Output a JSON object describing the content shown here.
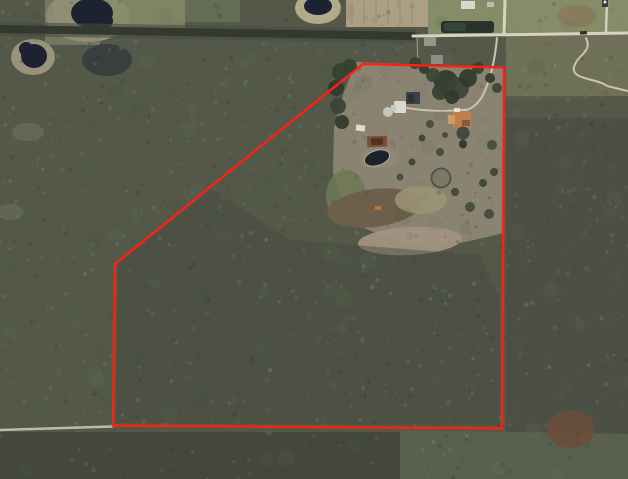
{
  "meta": {
    "description": "Aerial satellite view of a rural wooded parcel with a red property-boundary outline, a homestead clearing with buildings in the upper middle, ponds at top left, and dirt roads",
    "canvas": {
      "width": 628,
      "height": 479
    }
  },
  "palette": {
    "forest_base": "#535848",
    "forest_dark": "#33382e",
    "forest_light": "#7e8573",
    "clearing": "#8b8372",
    "water": "#1d2233",
    "road_light": "#d8d3c1",
    "boundary_red": "#ff2014"
  },
  "boundary": {
    "name": "property-boundary",
    "color": "#ff2014",
    "stroke_width": 2.4,
    "points": "363,64 504,67.5 502,428.5 113,425.5 115,264 210,187"
  },
  "terrain_regions": [
    {
      "name": "forest-base",
      "shape": "rect",
      "x": 0,
      "y": 0,
      "w": 628,
      "h": 479,
      "fill": "#535848"
    },
    {
      "name": "shore-northwest-pond",
      "shape": "ellipse",
      "cx": 88,
      "cy": 16,
      "rx": 42,
      "ry": 26,
      "fill": "#98937a"
    },
    {
      "name": "shore-west-pond",
      "shape": "ellipse",
      "cx": 33,
      "cy": 57,
      "rx": 22,
      "ry": 18,
      "fill": "#98937a"
    },
    {
      "name": "shore-connector",
      "shape": "rect",
      "x": 45,
      "y": 0,
      "w": 55,
      "h": 45,
      "fill": "#8d8871",
      "opacity": 0.6
    },
    {
      "name": "field-northwest",
      "shape": "rect",
      "x": 95,
      "y": 0,
      "w": 90,
      "h": 30,
      "fill": "#868c6a",
      "opacity": 0.85
    },
    {
      "name": "field-north",
      "shape": "rect",
      "x": 185,
      "y": 0,
      "w": 55,
      "h": 22,
      "fill": "#6f765c",
      "opacity": 0.7
    },
    {
      "name": "shore-north-center-pond",
      "shape": "ellipse",
      "cx": 318,
      "cy": 8,
      "rx": 23,
      "ry": 16,
      "fill": "#b3aa8c"
    },
    {
      "name": "plowed-field-north",
      "shape": "rect",
      "x": 346,
      "y": 0,
      "w": 82,
      "h": 27,
      "fill": "#ac9f83"
    },
    {
      "name": "lawn-northeast",
      "shape": "polygon",
      "points": "428,0 628,0 628,32 428,34",
      "fill": "#858d68"
    },
    {
      "name": "bare-patch-northeast",
      "shape": "ellipse",
      "cx": 577,
      "cy": 16,
      "rx": 20,
      "ry": 11,
      "fill": "#8a795c",
      "opacity": 0.85
    },
    {
      "name": "scrub-field-east",
      "shape": "polygon",
      "points": "506,36 628,34 628,96 506,101",
      "fill": "#6e7157"
    },
    {
      "name": "scrub-fade-east",
      "shape": "rect",
      "x": 506,
      "y": 96,
      "w": 122,
      "h": 26,
      "fill": "#565749",
      "opacity": 0.85
    },
    {
      "name": "forest-east",
      "shape": "rect",
      "x": 506,
      "y": 118,
      "w": 122,
      "h": 361,
      "fill": "#4b5044",
      "opacity": 0.9
    },
    {
      "name": "homestead-clearing",
      "shape": "polygon",
      "points": "356,62 504,68 504,233 470,241 432,248 396,241 364,228 342,206 333,172 334,128 344,92",
      "fill": "#8b8372"
    },
    {
      "name": "meadow-west-of-clearing",
      "shape": "ellipse",
      "cx": 346,
      "cy": 196,
      "rx": 20,
      "ry": 26,
      "fill": "#6e7854",
      "opacity": 0.9
    },
    {
      "name": "dirt-swath",
      "shape": "ellipse",
      "cx": 374,
      "cy": 208,
      "rx": 47,
      "ry": 19,
      "rot": -7,
      "fill": "#6e5f4b"
    },
    {
      "name": "sand-patch-south-of-clearing",
      "shape": "ellipse",
      "cx": 410,
      "cy": 241,
      "rx": 52,
      "ry": 14,
      "rot": -3,
      "fill": "#a1927e",
      "opacity": 0.95
    },
    {
      "name": "dry-grass-patch",
      "shape": "ellipse",
      "cx": 421,
      "cy": 200,
      "rx": 26,
      "ry": 14,
      "fill": "#9b9376",
      "opacity": 0.9
    },
    {
      "name": "interior-forest-tint",
      "shape": "polygon",
      "points": "118,262 212,189 290,240 480,255 500,300 500,425 116,423",
      "fill": "#454a3d",
      "opacity": 0.45
    },
    {
      "name": "bottom-forest-dark",
      "shape": "rect",
      "x": 0,
      "y": 432,
      "w": 400,
      "h": 47,
      "fill": "#41463b",
      "opacity": 0.9
    },
    {
      "name": "bottom-forest-light",
      "shape": "polygon",
      "points": "400,430 628,434 628,479 400,479",
      "fill": "#5a604e"
    },
    {
      "name": "rust-patch-southeast",
      "shape": "ellipse",
      "cx": 571,
      "cy": 429,
      "rx": 24,
      "ry": 19,
      "fill": "#6b4e39",
      "opacity": 0.85
    },
    {
      "name": "light-gap-west-1",
      "shape": "ellipse",
      "cx": 28,
      "cy": 132,
      "rx": 16,
      "ry": 9,
      "fill": "#6d735c",
      "opacity": 0.6
    },
    {
      "name": "light-gap-west-2",
      "shape": "ellipse",
      "cx": 10,
      "cy": 212,
      "rx": 13,
      "ry": 8,
      "fill": "#6d735c",
      "opacity": 0.5
    },
    {
      "name": "shadow-thicket-northwest",
      "shape": "ellipse",
      "cx": 107,
      "cy": 60,
      "rx": 25,
      "ry": 16,
      "fill": "#2e343a",
      "opacity": 0.7
    }
  ],
  "texture": {
    "seed": 1337,
    "blobs": {
      "count": 170,
      "r_min": 3,
      "r_max": 9,
      "colors": [
        "#636a58",
        "#4a5042",
        "#757b66"
      ],
      "opacity": 0.12
    },
    "specks": {
      "count": 1250,
      "r_min": 0.7,
      "r_max": 2.4,
      "colors": [
        "#7e8573",
        "#8f957f",
        "#6b7160",
        "#3a3f33",
        "#2f352a"
      ],
      "opacity_min": 0.14,
      "opacity_max": 0.32
    }
  },
  "water": [
    {
      "name": "pond-northwest",
      "shape": "ellipse",
      "cx": 92,
      "cy": 13,
      "rx": 21,
      "ry": 15,
      "fill": "#1d2233"
    },
    {
      "name": "pond-northwest-lobe",
      "shape": "circle",
      "cx": 105,
      "cy": 21,
      "r": 8,
      "fill": "#1d2233"
    },
    {
      "name": "pond-west",
      "shape": "ellipse",
      "cx": 34,
      "cy": 56,
      "rx": 13,
      "ry": 12,
      "fill": "#1d2233"
    },
    {
      "name": "pond-west-lobe",
      "shape": "circle",
      "cx": 26,
      "cy": 49,
      "r": 7,
      "fill": "#1d2233"
    },
    {
      "name": "pond-north-center",
      "shape": "ellipse",
      "cx": 318,
      "cy": 6,
      "rx": 14,
      "ry": 9,
      "fill": "#1d2233"
    }
  ],
  "roads": [
    {
      "name": "tree-lined-lane-outer",
      "d": "M 0,29 C 130,30 270,33 413,36",
      "stroke": "#474c41",
      "width": 14,
      "opacity": 0.6
    },
    {
      "name": "tree-lined-lane-core",
      "d": "M 0,29 C 130,30 270,33 413,36",
      "stroke": "#33382e",
      "width": 8,
      "opacity": 0.95
    },
    {
      "name": "top-road",
      "d": "M 413,36 C 480,35 560,34 628,33",
      "stroke": "#d8d3c1",
      "width": 3
    },
    {
      "name": "north-spur-road-west",
      "d": "M 505,0 L 504,35",
      "stroke": "#d8d3c1",
      "width": 3
    },
    {
      "name": "north-spur-road-east",
      "d": "M 607,0 L 606,33",
      "stroke": "#d4cfc0",
      "width": 2.4
    },
    {
      "name": "winding-trail-east",
      "d": "M 586,38 C 593,52 577,55 574,67 C 571,80 597,78 607,86 L 628,91",
      "stroke": "#ccc5ae",
      "width": 2
    },
    {
      "name": "driveway",
      "d": "M 497,38 C 495,60 490,80 483,95 C 477,106 470,110 462,111",
      "stroke": "#cbc5b0",
      "width": 2
    },
    {
      "name": "driveway-branch",
      "d": "M 470,109 C 448,112 424,111 407,108",
      "stroke": "#cbc5b0",
      "width": 1.7
    },
    {
      "name": "pad-link",
      "d": "M 407,108 L 394,111",
      "stroke": "#c4bfae",
      "width": 1.4
    },
    {
      "name": "bottom-dirt-road",
      "d": "M 0,430 L 112,426.5",
      "stroke": "#c2bba3",
      "width": 2.6
    },
    {
      "name": "fence-line",
      "d": "M 417,36 L 418,65",
      "stroke": "#b5b1a0",
      "width": 1,
      "opacity": 0.8
    },
    {
      "name": "field-row-1",
      "d": "M 352,2 L 352,24",
      "stroke": "#97896c",
      "width": 1.2,
      "opacity": 0.75
    },
    {
      "name": "field-row-2",
      "d": "M 364,2 L 364,24",
      "stroke": "#97896c",
      "width": 1.2,
      "opacity": 0.75
    },
    {
      "name": "field-row-3",
      "d": "M 376,2 L 376,24",
      "stroke": "#97896c",
      "width": 1.2,
      "opacity": 0.75
    },
    {
      "name": "field-row-4",
      "d": "M 388,2 L 388,24",
      "stroke": "#97896c",
      "width": 1.2,
      "opacity": 0.75
    },
    {
      "name": "field-row-5",
      "d": "M 400,2 L 400,24",
      "stroke": "#97896c",
      "width": 1.2,
      "opacity": 0.75
    },
    {
      "name": "field-row-6",
      "d": "M 412,2 L 412,24",
      "stroke": "#97896c",
      "width": 1.2,
      "opacity": 0.75
    }
  ],
  "trees": [
    {
      "name": "tree-canopy",
      "cx": 446,
      "cy": 82,
      "r": 12,
      "fill": "#2f3a2d"
    },
    {
      "name": "tree-canopy",
      "cx": 458,
      "cy": 88,
      "r": 11,
      "fill": "#3a4435"
    },
    {
      "name": "tree-canopy",
      "cx": 468,
      "cy": 78,
      "r": 9,
      "fill": "#2f3a2d"
    },
    {
      "name": "tree-canopy",
      "cx": 440,
      "cy": 92,
      "r": 8,
      "fill": "#35402f"
    },
    {
      "name": "tree-canopy",
      "cx": 452,
      "cy": 97,
      "r": 7,
      "fill": "#2f3a2d"
    },
    {
      "name": "tree-canopy",
      "cx": 433,
      "cy": 75,
      "r": 7,
      "fill": "#3a4435"
    },
    {
      "name": "tree-canopy",
      "cx": 415,
      "cy": 63,
      "r": 6,
      "fill": "#35402f"
    },
    {
      "name": "tree-canopy",
      "cx": 424,
      "cy": 69,
      "r": 5,
      "fill": "#2f3a2d"
    },
    {
      "name": "tree-canopy",
      "cx": 478,
      "cy": 68,
      "r": 6,
      "fill": "#35402f"
    },
    {
      "name": "tree-canopy",
      "cx": 490,
      "cy": 78,
      "r": 5,
      "fill": "#2f3a2d"
    },
    {
      "name": "tree-canopy",
      "cx": 497,
      "cy": 88,
      "r": 5,
      "fill": "#3a4435"
    },
    {
      "name": "tree-canopy",
      "cx": 341,
      "cy": 72,
      "r": 9,
      "fill": "#35402f"
    },
    {
      "name": "tree-canopy",
      "cx": 336,
      "cy": 88,
      "r": 8,
      "fill": "#2f3a2d"
    },
    {
      "name": "tree-canopy",
      "cx": 338,
      "cy": 106,
      "r": 8,
      "fill": "#3a4435"
    },
    {
      "name": "tree-canopy",
      "cx": 342,
      "cy": 122,
      "r": 7,
      "fill": "#2f3a2d"
    },
    {
      "name": "tree-canopy",
      "cx": 350,
      "cy": 66,
      "r": 7,
      "fill": "#35402f"
    },
    {
      "name": "tree-canopy",
      "cx": 430,
      "cy": 124,
      "r": 4,
      "fill": "#434c3b"
    },
    {
      "name": "tree-canopy",
      "cx": 422,
      "cy": 138,
      "r": 3.5,
      "fill": "#3a4435"
    },
    {
      "name": "tree-canopy",
      "cx": 440,
      "cy": 152,
      "r": 4,
      "fill": "#434c3b"
    },
    {
      "name": "tree-canopy",
      "cx": 412,
      "cy": 162,
      "r": 3.5,
      "fill": "#3a4435"
    },
    {
      "name": "tree-canopy",
      "cx": 400,
      "cy": 177,
      "r": 3.5,
      "fill": "#434c3b"
    },
    {
      "name": "tree-canopy",
      "cx": 455,
      "cy": 192,
      "r": 4,
      "fill": "#3a4435"
    },
    {
      "name": "tree-canopy",
      "cx": 470,
      "cy": 207,
      "r": 5,
      "fill": "#434c3b"
    },
    {
      "name": "tree-canopy",
      "cx": 483,
      "cy": 183,
      "r": 4,
      "fill": "#3a4435"
    },
    {
      "name": "tree-canopy",
      "cx": 492,
      "cy": 145,
      "r": 5,
      "fill": "#434c3b"
    },
    {
      "name": "tree-canopy",
      "cx": 494,
      "cy": 172,
      "r": 4,
      "fill": "#3a4435"
    },
    {
      "name": "tree-canopy",
      "cx": 489,
      "cy": 214,
      "r": 5,
      "fill": "#434c3b"
    },
    {
      "name": "tree-canopy",
      "cx": 463,
      "cy": 120,
      "r": 3.5,
      "fill": "#3a4435"
    },
    {
      "name": "tree-canopy",
      "cx": 445,
      "cy": 135,
      "r": 3,
      "fill": "#434c3b"
    }
  ],
  "structures": [
    {
      "name": "greenhouse-building",
      "shape": "rect",
      "x": 441,
      "y": 21,
      "w": 53,
      "h": 12,
      "rx": 3,
      "fill": "#28332c"
    },
    {
      "name": "greenhouse-highlight",
      "shape": "rect",
      "x": 444,
      "y": 23,
      "w": 22,
      "h": 8,
      "rx": 2,
      "fill": "#374439"
    },
    {
      "name": "white-house-top-road",
      "shape": "rect",
      "x": 461,
      "y": 1,
      "w": 14,
      "h": 8,
      "fill": "#d7d6d0"
    },
    {
      "name": "shed-top-road",
      "shape": "rect",
      "x": 487,
      "y": 2,
      "w": 7,
      "h": 5,
      "fill": "#bcbbb4"
    },
    {
      "name": "gray-house-north-a",
      "shape": "rect",
      "x": 424,
      "y": 37,
      "w": 12,
      "h": 9,
      "fill": "#95958d"
    },
    {
      "name": "gray-house-north-b",
      "shape": "rect",
      "x": 431,
      "y": 55,
      "w": 12,
      "h": 9,
      "fill": "#8c8d85"
    },
    {
      "name": "marker-northeast",
      "shape": "rect",
      "x": 602,
      "y": 0,
      "w": 6,
      "h": 7,
      "fill": "#3b3b3b"
    },
    {
      "name": "marker-northeast-dot",
      "shape": "circle",
      "cx": 605,
      "cy": 2,
      "r": 1.5,
      "fill": "#e8e8e8"
    },
    {
      "name": "vehicle-on-road",
      "shape": "rect",
      "x": 580,
      "y": 31,
      "w": 7,
      "h": 3.5,
      "rot": -4,
      "fill": "#34352f"
    },
    {
      "name": "dark-roof-house",
      "shape": "rect",
      "x": 406,
      "y": 92,
      "w": 14,
      "h": 12,
      "rx": 1,
      "fill": "#3b4047"
    },
    {
      "name": "dark-roof-panels",
      "shape": "rect",
      "x": 408,
      "y": 94,
      "w": 6,
      "h": 8,
      "fill": "#2e333a"
    },
    {
      "name": "white-house",
      "shape": "rect",
      "x": 394,
      "y": 101,
      "w": 12,
      "h": 12,
      "rx": 1,
      "fill": "#dbdad2"
    },
    {
      "name": "white-house-wing",
      "shape": "rect",
      "x": 391,
      "y": 105,
      "w": 5,
      "h": 6,
      "fill": "#c8c8c0"
    },
    {
      "name": "concrete-pad",
      "shape": "circle",
      "cx": 388,
      "cy": 112,
      "r": 5,
      "fill": "#c7c6bb"
    },
    {
      "name": "orange-roof-house",
      "shape": "rect",
      "x": 453,
      "y": 111,
      "w": 18,
      "h": 16,
      "rx": 1,
      "fill": "#bf7f4a"
    },
    {
      "name": "orange-roof-wing",
      "shape": "rect",
      "x": 448,
      "y": 115,
      "w": 7,
      "h": 9,
      "fill": "#cf9a60"
    },
    {
      "name": "orange-house-white-bit",
      "shape": "rect",
      "x": 454,
      "y": 108,
      "w": 6,
      "h": 4,
      "fill": "#e6e0d2"
    },
    {
      "name": "orange-house-shadow-bit",
      "shape": "rect",
      "x": 462,
      "y": 120,
      "w": 8,
      "h": 6,
      "fill": "#8a5a34"
    },
    {
      "name": "round-outbuilding",
      "shape": "circle",
      "cx": 463,
      "cy": 133,
      "r": 6.5,
      "fill": "#45483e"
    },
    {
      "name": "round-outbuilding-small",
      "shape": "ellipse",
      "cx": 463,
      "cy": 144,
      "rx": 4,
      "ry": 4.5,
      "fill": "#383b33"
    },
    {
      "name": "barn",
      "shape": "rect",
      "x": 367,
      "y": 136,
      "w": 20,
      "h": 11,
      "rx": 1,
      "rot": -2,
      "fill": "#7c5132"
    },
    {
      "name": "barn-roof-center",
      "shape": "rect",
      "x": 371,
      "y": 138,
      "w": 12,
      "h": 7,
      "rot": -2,
      "fill": "#523420"
    },
    {
      "name": "pool-apron",
      "shape": "ellipse",
      "cx": 379,
      "cy": 158,
      "rx": 19,
      "ry": 11,
      "fill": "#8e8878"
    },
    {
      "name": "pond-pool",
      "shape": "ellipse",
      "cx": 377,
      "cy": 158,
      "rx": 13,
      "ry": 7.5,
      "rot": -18,
      "fill": "#1d212b",
      "stroke": "#b5ad97",
      "stroke_width": 1
    },
    {
      "name": "round-pen",
      "shape": "circle",
      "cx": 441,
      "cy": 178,
      "r": 9.5,
      "fill": "#7d7766",
      "stroke": "#51564b",
      "stroke_width": 2
    },
    {
      "name": "white-shed-small",
      "shape": "rect",
      "x": 356,
      "y": 125,
      "w": 9,
      "h": 6,
      "rot": 8,
      "fill": "#dcddd6"
    },
    {
      "name": "orange-equipment",
      "shape": "rect",
      "x": 375,
      "y": 206,
      "w": 6,
      "h": 4,
      "fill": "#bf7430"
    }
  ]
}
